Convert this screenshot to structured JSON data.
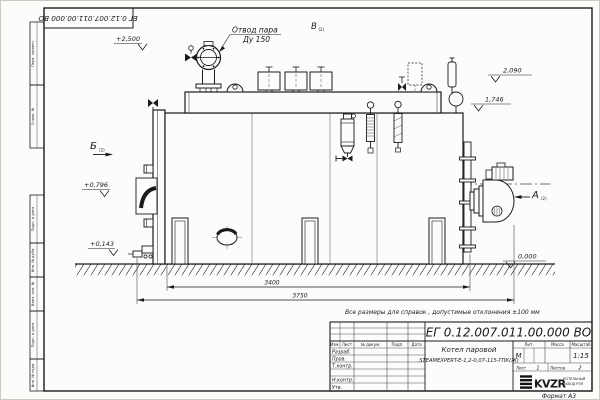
{
  "doc_box": {
    "number": "ЕГ 0.12.007.011.00.000 ВО"
  },
  "margin": {
    "labels": [
      "Перв. примен.",
      "Справ. №",
      "Подп. и дата",
      "Инв. № дубл.",
      "Взам. инв. №",
      "Подп. и дата",
      "Инв. № подл."
    ]
  },
  "drawing": {
    "callout": {
      "line1": "Отвод пара",
      "line2": "Ду 150"
    },
    "views": {
      "a": "А",
      "b": "Б",
      "v": "В",
      "sub": "(2)"
    },
    "elevations": {
      "top": "+2,500",
      "e2090": "2,090",
      "e1746": "1,746",
      "e0796": "+0,796",
      "e0143": "+0,143",
      "zero": "0,000"
    },
    "dims": {
      "span": "3400",
      "overall": "3750"
    }
  },
  "stamp": {
    "note": "Все размеры для справок , допустимые отклонения ±100 мм",
    "doc_number": "ЕГ 0.12.007.011.00.000 ВО",
    "product_line1": "Котел паровой",
    "product_line2": "STEAMEXPERT-Е-1,2-0,07-115-ГПК(Ж)",
    "header": {
      "izm": "Изм.",
      "list": "Лист",
      "ndok": "№ докум.",
      "podp": "Подп.",
      "data": "Дата"
    },
    "signers": [
      "Разраб.",
      "Пров.",
      "Т.контр.",
      "Н.контр.",
      "Утв."
    ],
    "lit_label": "Лит.",
    "lit_value": "М",
    "mass_label": "Масса",
    "scale_label": "Масштаб",
    "scale_value": "1:15",
    "sheet_label": "Лист",
    "sheet_value": "1",
    "sheets_label": "Листов",
    "sheets_value": "2",
    "logo": "KVZR",
    "logo_sub1": "КОТЕЛЬНЫЙ",
    "logo_sub2": "ЗАВОД РЭП",
    "format": "Формат А3"
  }
}
